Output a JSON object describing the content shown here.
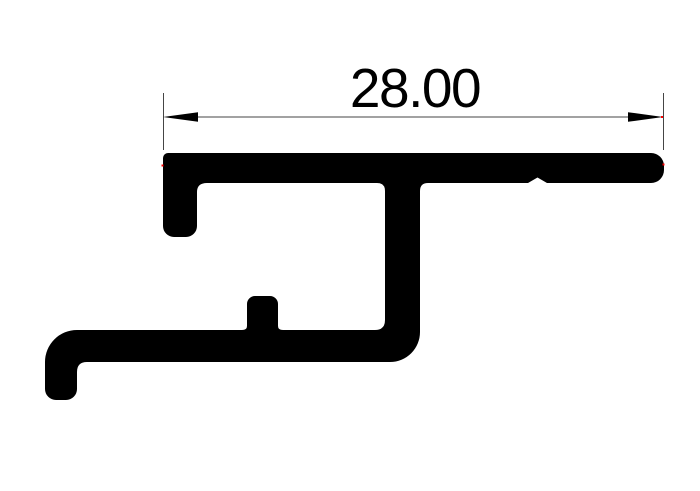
{
  "drawing": {
    "title": "aluminium extrusion profile cross-section with width dimension",
    "background_color": "#ffffff",
    "profile": {
      "description": "solid black cross-section silhouette of an aluminium frame profile",
      "fill_color": "#000000",
      "path": "M168,153 H651 A13,13 0 0 1 664,166 V170 A13,13 0 0 1 651,183 H547 L537.5,177.5 L528,183 H428 Q420,183 420,191 V332 A30,30 0 0 1 390,362 H87 Q77,362 77,372 V389 A11,11 0 0 1 66,400 H56 A11,11 0 0 1 45,389 V362 A32,32 0 0 1 77,330 H242 Q247,330 247,326 V304 A8,8 0 0 1 255,296 H270 A8,8 0 0 1 278,304 V326 Q278,330 283,330 H375 Q385,330 385,320 V191 Q385,183 377,183 H207 Q197,183 197,192 V226 A11,11 0 0 1 186,237 H174 A11,11 0 0 1 163,226 V158 A5,5 0 0 1 168,153 Z"
    },
    "dimension": {
      "label": "28.00",
      "label_x": 415,
      "label_y": 107,
      "font_size": 55,
      "text_color": "#000000",
      "line_color": "#6b6b6b",
      "ext_line_color": "#454545",
      "arrow_color": "#000000",
      "line_path": "M197,117 H629",
      "ext_left_path": "M163.5,93 V150",
      "ext_right_path": "M663.5,93 V150",
      "arrow_left_path": "M163,117 L198,112.2 L198,121.8 Z",
      "arrow_right_path": "M663,117 L628,112.2 L628,121.8 Z"
    },
    "cad_markers": {
      "description": "tiny red CAD endpoint marker dots",
      "color": "#ff0000",
      "path": "M161.5,164.5 h2 v2 h-2 Z M661,116 h2 v2 h-2 Z M662.5,163.5 h2 v2 h-2 Z"
    }
  }
}
